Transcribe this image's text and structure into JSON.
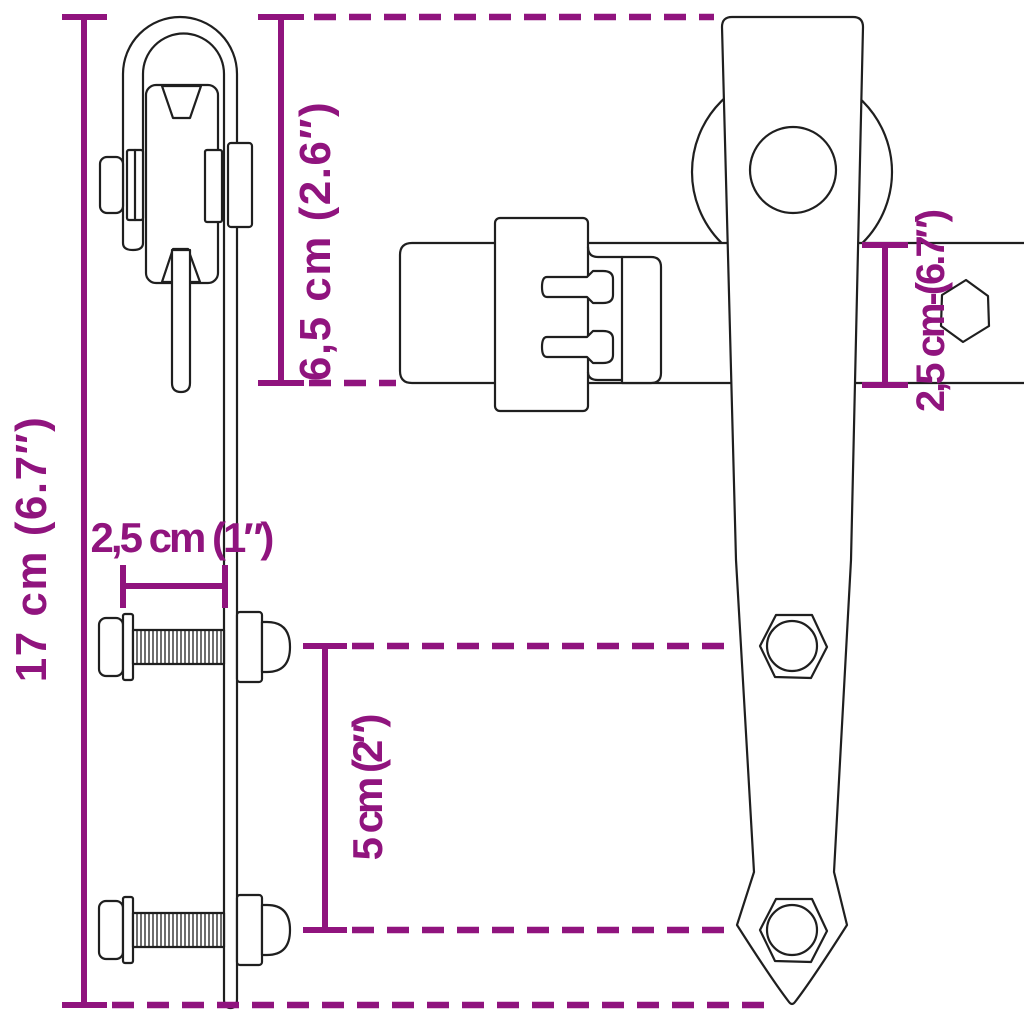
{
  "colors": {
    "dimension_accent": "#90147e",
    "lineart": "#1f1f1f",
    "background": "#ffffff"
  },
  "diagram": {
    "kind": "sliding-door-roller-hardware-dimension-drawing",
    "dimensions": {
      "overall_height": {
        "label": "17 cm (6.7″)",
        "orientation": "vertical-left"
      },
      "bracket_height": {
        "label": "6,5 cm (2.6″)",
        "orientation": "vertical"
      },
      "bolt_length": {
        "label": "2,5 cm (1″)",
        "orientation": "horizontal"
      },
      "hole_spacing": {
        "label": "5 cm (2″)",
        "orientation": "vertical"
      },
      "rail_offset": {
        "label": "2,5 cm-(6.7″)",
        "orientation": "vertical-right"
      }
    }
  }
}
